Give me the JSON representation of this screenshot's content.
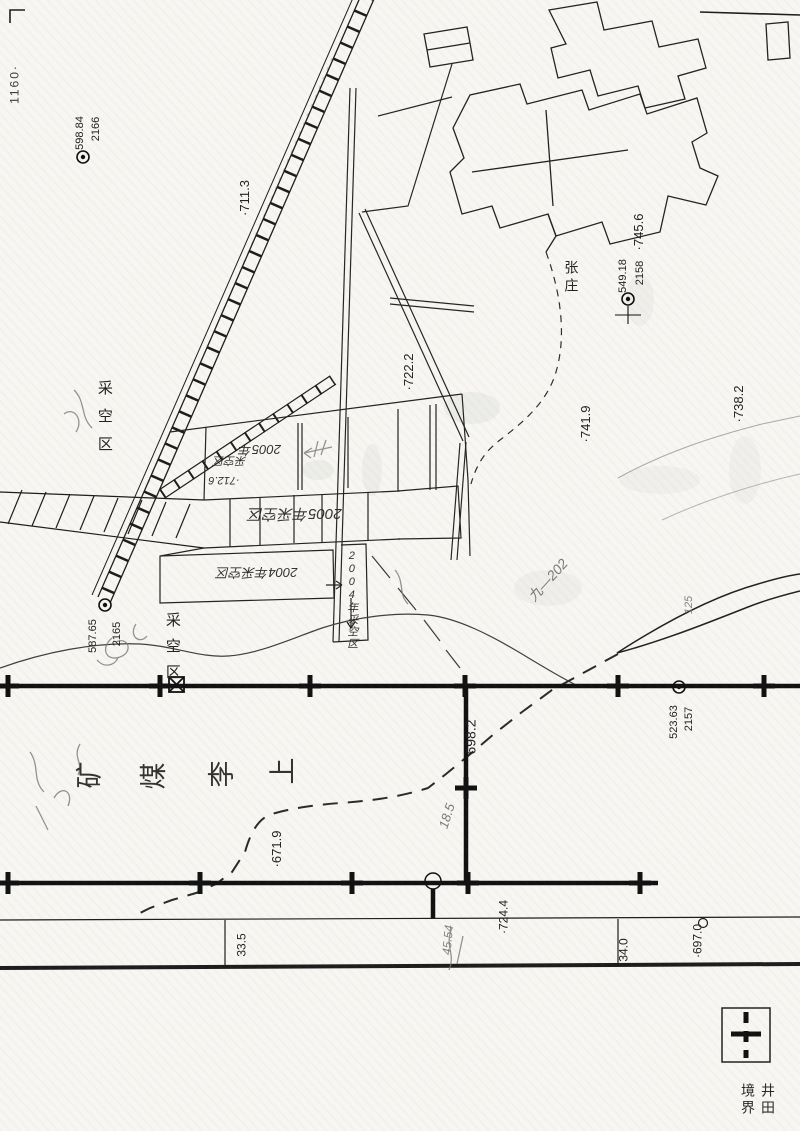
{
  "map_title": "上李煤矿 (mine plan scan)",
  "colors": {
    "paper": "#f7f6f2",
    "ink": "#1d1d1d",
    "pencil": "#6f6f6f"
  },
  "legend": {
    "symbol": "boundary-cross",
    "label": "井田境界"
  },
  "labels": [
    {
      "name": "grid-coordinate-1160",
      "text": "1160·",
      "x": 15,
      "y": 84,
      "rot": -90,
      "fs": 12,
      "ls": 2,
      "color": "#3c3c3c"
    },
    {
      "name": "benchmark-2166-number",
      "text": "2166",
      "x": 97,
      "y": 129,
      "rot": -90,
      "fs": 11
    },
    {
      "name": "benchmark-2166-elevation",
      "text": "598.84",
      "x": 81,
      "y": 133,
      "rot": -90,
      "fs": 11
    },
    {
      "name": "elevation-point-711-3",
      "text": "·711.3",
      "x": 245,
      "y": 198,
      "rot": -90,
      "fs": 13
    },
    {
      "name": "elevation-point-722-2",
      "text": "·722.2",
      "x": 409,
      "y": 372,
      "rot": -90,
      "fs": 13
    },
    {
      "name": "elevation-point-745-6",
      "text": "·745.6",
      "x": 639,
      "y": 232,
      "rot": -90,
      "fs": 13
    },
    {
      "name": "benchmark-2158-number",
      "text": "2158",
      "x": 641,
      "y": 273,
      "rot": -90,
      "fs": 11
    },
    {
      "name": "benchmark-2158-elevation",
      "text": "549.18",
      "x": 624,
      "y": 276,
      "rot": -90,
      "fs": 11
    },
    {
      "name": "village-name-zhangzhuang",
      "text": "张庄",
      "x": 571,
      "y": 260,
      "vertical": true,
      "fs": 14,
      "ls": 4
    },
    {
      "name": "elevation-point-741-9",
      "text": "·741.9",
      "x": 586,
      "y": 424,
      "rot": -90,
      "fs": 13
    },
    {
      "name": "elevation-point-738-2",
      "text": "·738.2",
      "x": 739,
      "y": 404,
      "rot": -90,
      "fs": 13
    },
    {
      "name": "goaf-area-label-1",
      "text": "采空区",
      "x": 104,
      "y": 380,
      "vertical": true,
      "fs": 15,
      "ls": 13
    },
    {
      "name": "handwritten-2005",
      "text": "2005年",
      "x": 260,
      "y": 449,
      "rot": 180,
      "fs": 13,
      "cls": "hw"
    },
    {
      "name": "handwritten-goaf",
      "text": "采空区",
      "x": 230,
      "y": 459,
      "rot": 180,
      "fs": 11,
      "cls": "hw"
    },
    {
      "name": "handwritten-712-6",
      "text": "·712.6",
      "x": 224,
      "y": 479,
      "rot": 180,
      "fs": 11,
      "cls": "hw"
    },
    {
      "name": "handwritten-2005-goaf",
      "text": "2005年采空区",
      "x": 295,
      "y": 513,
      "rot": 180,
      "fs": 15,
      "cls": "hw"
    },
    {
      "name": "handwritten-2004-goaf",
      "text": "2004年采空区",
      "x": 257,
      "y": 572,
      "rot": 180,
      "fs": 13,
      "cls": "hw"
    },
    {
      "name": "goaf-2004-box-label",
      "text": "2004年采空区",
      "x": 351,
      "y": 550,
      "vertical": true,
      "fs": 11,
      "ls": 1,
      "cls": "hw"
    },
    {
      "name": "benchmark-2165-number",
      "text": "2165",
      "x": 118,
      "y": 634,
      "rot": -90,
      "fs": 11
    },
    {
      "name": "benchmark-2165-elevation",
      "text": "587.65",
      "x": 94,
      "y": 636,
      "rot": -90,
      "fs": 11
    },
    {
      "name": "goaf-area-label-2",
      "text": "采空区",
      "x": 172,
      "y": 612,
      "vertical": true,
      "fs": 15,
      "ls": 11
    },
    {
      "name": "elevation-point-698-2",
      "text": "698.2",
      "x": 471,
      "y": 737,
      "rot": -90,
      "fs": 14
    },
    {
      "name": "benchmark-2157-number",
      "text": "2157",
      "x": 690,
      "y": 719,
      "rot": -90,
      "fs": 11
    },
    {
      "name": "benchmark-2157-elevation",
      "text": "523.63",
      "x": 675,
      "y": 722,
      "rot": -90,
      "fs": 11
    },
    {
      "name": "mine-name-char-kuang",
      "text": "矿",
      "x": 90,
      "y": 775,
      "rot": -90,
      "fs": 27,
      "color": "#333"
    },
    {
      "name": "mine-name-char-mei",
      "text": "煤",
      "x": 154,
      "y": 776,
      "rot": -90,
      "fs": 27,
      "color": "#333"
    },
    {
      "name": "mine-name-char-li",
      "text": "李",
      "x": 222,
      "y": 774,
      "rot": -90,
      "fs": 27,
      "color": "#333"
    },
    {
      "name": "mine-name-char-shang",
      "text": "上",
      "x": 283,
      "y": 771,
      "rot": -90,
      "fs": 27,
      "color": "#333"
    },
    {
      "name": "elevation-point-671-9",
      "text": "·671.9",
      "x": 277,
      "y": 849,
      "rot": -90,
      "fs": 13
    },
    {
      "name": "elevation-point-724-4",
      "text": "·724.4",
      "x": 504,
      "y": 917,
      "rot": -90,
      "fs": 12
    },
    {
      "name": "distance-33-5",
      "text": "33.5",
      "x": 242,
      "y": 945,
      "rot": -90,
      "fs": 12
    },
    {
      "name": "distance-34-0",
      "text": "34.0",
      "x": 624,
      "y": 950,
      "rot": -90,
      "fs": 12
    },
    {
      "name": "elevation-point-697-0",
      "text": "·697.0",
      "x": 698,
      "y": 941,
      "rot": -90,
      "fs": 12
    },
    {
      "name": "pencil-note-9-202",
      "text": "九—202",
      "x": 548,
      "y": 580,
      "rot": -48,
      "fs": 14,
      "cls": "hw",
      "color": "#6f6f6f"
    },
    {
      "name": "pencil-note-125",
      "text": "125",
      "x": 690,
      "y": 605,
      "rot": -90,
      "fs": 11,
      "cls": "hw",
      "color": "#7a7a7a"
    },
    {
      "name": "pencil-note-18-5",
      "text": "18.5",
      "x": 447,
      "y": 816,
      "rot": -72,
      "fs": 13,
      "cls": "hw",
      "color": "#6f6f6f"
    },
    {
      "name": "pencil-note-45-54",
      "text": "45.54",
      "x": 448,
      "y": 940,
      "rot": -85,
      "fs": 12,
      "cls": "hw",
      "color": "#7a7a7a"
    }
  ]
}
